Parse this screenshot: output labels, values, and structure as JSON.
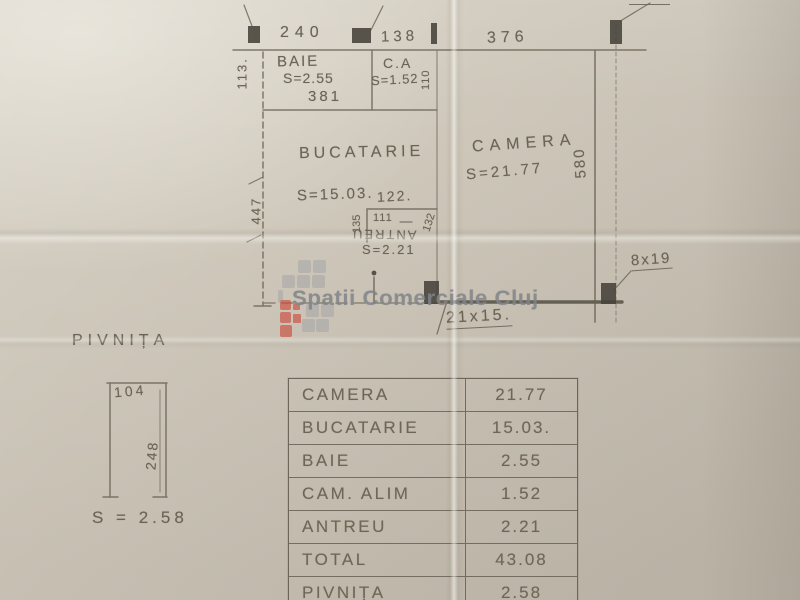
{
  "watermark": {
    "text": "Spatii Comerciale Cluj",
    "gray": "#a9a9a9",
    "red": "#cc4433"
  },
  "plan": {
    "dims": {
      "top_left": "240",
      "top_mid": "138",
      "top_right": "376",
      "left_upper": "113.",
      "baie_width": "381",
      "ca_side": "110",
      "left_height": "447",
      "right_height": "580",
      "antreu_top": "122.",
      "antreu_left": "135",
      "antreu_inner": "111",
      "antreu_right": "132",
      "pillar_note_top": "8x19",
      "pillar_note": "8x19",
      "step_note": "21x15."
    },
    "rooms": {
      "baie": {
        "name": "BAIE",
        "area": "S=2.55"
      },
      "ca": {
        "name": "C.A",
        "area": "S=1.52"
      },
      "bucatarie": {
        "name": "BUCATARIE",
        "area": "S=15.03."
      },
      "camera": {
        "name": "CAMERA",
        "area": "S=21.77"
      },
      "antreu": {
        "name": "ANTREU",
        "area": "S=2.21"
      }
    }
  },
  "pivnita": {
    "title": "PIVNIȚA",
    "width": "104",
    "depth": "248",
    "area": "S = 2.58"
  },
  "areas_table": {
    "rows": [
      {
        "label": "CAMERA",
        "value": "21.77"
      },
      {
        "label": "BUCATARIE",
        "value": "15.03."
      },
      {
        "label": "BAIE",
        "value": "2.55"
      },
      {
        "label": "CAM. ALIM",
        "value": "1.52"
      },
      {
        "label": "ANTREU",
        "value": "2.21"
      },
      {
        "label": "TOTAL",
        "value": "43.08"
      },
      {
        "label": "PIVNIȚA",
        "value": "2.58"
      }
    ]
  }
}
